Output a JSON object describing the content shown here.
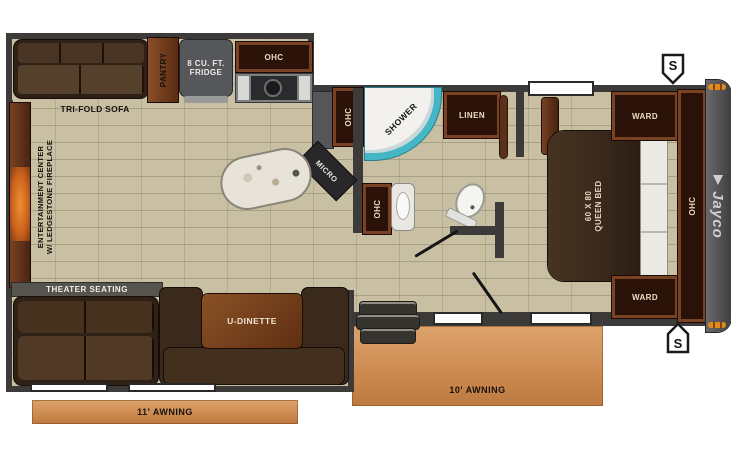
{
  "floorplan": {
    "brand": "Jayco",
    "labels": {
      "tri_fold_sofa": "TRI-FOLD SOFA",
      "pantry": "PANTRY",
      "fridge_line1": "8 CU. FT.",
      "fridge_line2": "FRIDGE",
      "ohc": "OHC",
      "micro": "MICRO",
      "shower": "SHOWER",
      "linen": "LINEN",
      "entertainment_line1": "ENTERTAINMENT CENTER",
      "entertainment_line2": "W/ LEDGESTONE FIREPLACE",
      "theater_seating": "THEATER SEATING",
      "u_dinette": "U-DINETTE",
      "queen_bed_line1": "60 X 80",
      "queen_bed_line2": "QUEEN BED",
      "ward": "WARD",
      "awning_front": "11' AWNING",
      "awning_rear": "10' AWNING",
      "speaker": "S"
    },
    "colors": {
      "wall": "#3c3b39",
      "floor_tile": "#c9c0a3",
      "cabinet_wood": "#7a4224",
      "cabinet_interior": "#2a1208",
      "furniture_brown": "#3a2a1c",
      "awning_orange": "#cf9156",
      "shower_accent": "#45b6c6",
      "rear_cap_gray": "#4b4b4d",
      "marker_light_orange": "#e08a1e",
      "label_light": "#ecdcc2",
      "label_dark": "#13110c"
    }
  }
}
